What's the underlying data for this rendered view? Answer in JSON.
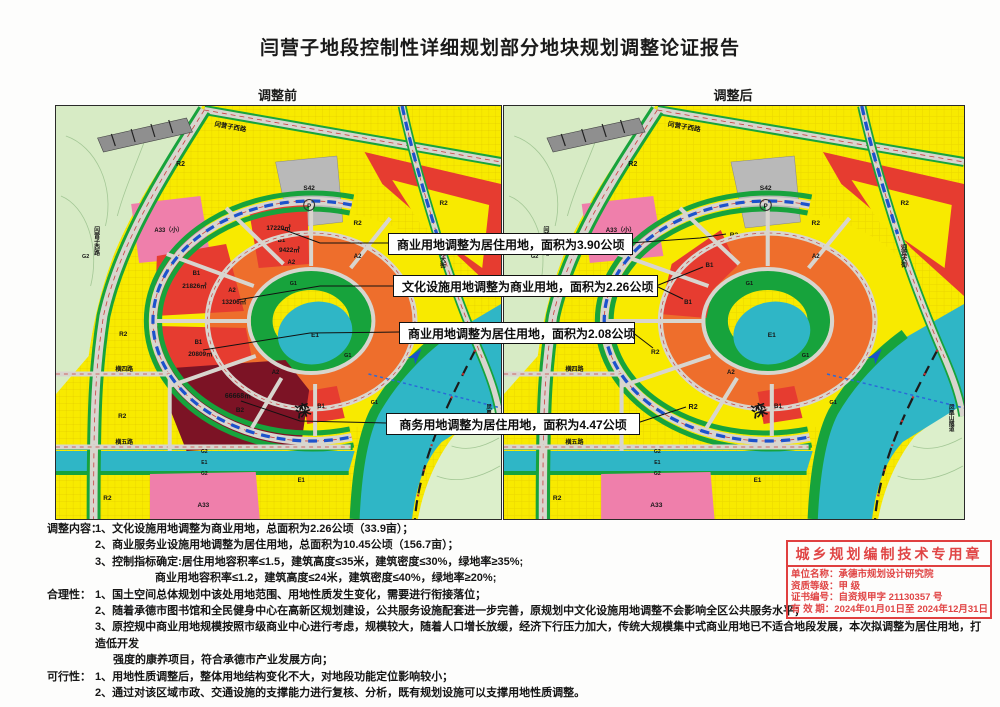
{
  "page": {
    "title": "闫营子地段控制性详细规划部分地块规划调整论证报告"
  },
  "maps": {
    "before": {
      "caption": "调整前",
      "parcels": {
        "b1_n_area": "17220㎡",
        "b1_n": "B1",
        "a2_n_area": "9422㎡",
        "a2_n": "A2",
        "b1_w": "B1",
        "b1_w_area": "21826㎡",
        "a2_w": "A2",
        "a2_w_area": "13206㎡",
        "b1_sw": "B1",
        "b1_sw_area": "20809㎡",
        "b2_area": "66668㎡",
        "b2": "B2"
      }
    },
    "after": {
      "caption": "调整后",
      "parcels": {
        "r2_n": "R2",
        "r2_w": "R2",
        "r2_sw": "R2",
        "r2_s": "R2",
        "b1_inner_n": "B1",
        "b1_inner_w": "B1"
      }
    }
  },
  "base": {
    "zones": {
      "r2_a": "R2",
      "r2_b": "R2",
      "r2_c": "R2",
      "r2_d": "R2",
      "r2_e": "R2",
      "r2_core": "R2",
      "a2_a": "A2",
      "a2_b": "A2",
      "b1_s": "B1",
      "e1_lake": "E1",
      "e1_river": "E1",
      "e1_canal": "E1",
      "g1_a": "G1",
      "g1_b": "G1",
      "g1_c": "G1",
      "g2_a": "G2",
      "g2_b": "G2",
      "g2_c": "G2",
      "s42": "S42",
      "p": "P",
      "a33_small": "A33（小）",
      "a33": "A33",
      "river_name": "滦"
    },
    "roads": {
      "yanyingzi": "闫营子西路",
      "heng4": "横四路",
      "heng5": "横五路",
      "yingbin": "迎宾大街",
      "tunnel": "凤凰山隧道"
    }
  },
  "annotations": [
    {
      "text": "商业用地调整为居住用地，面积为3.90公顷"
    },
    {
      "text": "文化设施用地调整为商业用地，面积为2.26公顷"
    },
    {
      "text": "商业用地调整为居住用地，面积为2.08公顷"
    },
    {
      "text": "商务用地调整为居住用地，面积为4.47公顷"
    }
  ],
  "notes": {
    "lines": [
      {
        "label": "调整内容：",
        "text": "1、文化设施用地调整为商业用地，总面积为2.26公顷（33.9亩）；"
      },
      {
        "label": "",
        "text": "2、商业服务业设施用地调整为居住用地，总面积为10.45公顷（156.7亩）；"
      },
      {
        "label": "",
        "text": "3、控制指标确定:居住用地容积率≤1.5，建筑高度≤35米，建筑密度≤30%，绿地率≥35%;"
      },
      {
        "label": "",
        "text": "商业用地容积率≤1.2，建筑高度≤24米，建筑密度≤40%，绿地率≥20%;"
      },
      {
        "label": "合理性：",
        "text": "1、国土空间总体规划中该处用地范围、用地性质发生变化，需要进行衔接落位；"
      },
      {
        "label": "",
        "text": "2、随着承德市图书馆和全民健身中心在高新区规划建设，公共服务设施配套进一步完善，原规划中文化设施用地调整不会影响全区公共服务水平；"
      },
      {
        "label": "",
        "text": "3、原控规中商业用地规模按照市级商业中心进行考虑，规模较大，随着人口增长放缓，经济下行压力加大，传统大规模集中式商业用地已不适合地段发展，本次拟调整为居住用地，打造低开发"
      },
      {
        "label": "",
        "text": "强度的康养项目，符合承德市产业发展方向；"
      },
      {
        "label": "可行性：",
        "text": "1、用地性质调整后，整体用地结构变化不大，对地段功能定位影响较小；"
      },
      {
        "label": "",
        "text": "2、通过对该区域市政、交通设施的支撑能力进行复核、分析，既有规划设施可以支撑用地性质调整。"
      }
    ]
  },
  "stamp": {
    "title": "城乡规划编制技术专用章",
    "rows": [
      {
        "label": "单位名称：",
        "value": "承德市规划设计研究院"
      },
      {
        "label": "资质等级：",
        "value": "甲  级"
      },
      {
        "label": "证书编号：",
        "value": "自资规甲字 21130357 号"
      },
      {
        "label": "有 效 期：",
        "value": "2024年01月01日至 2024年12月31日"
      }
    ]
  }
}
